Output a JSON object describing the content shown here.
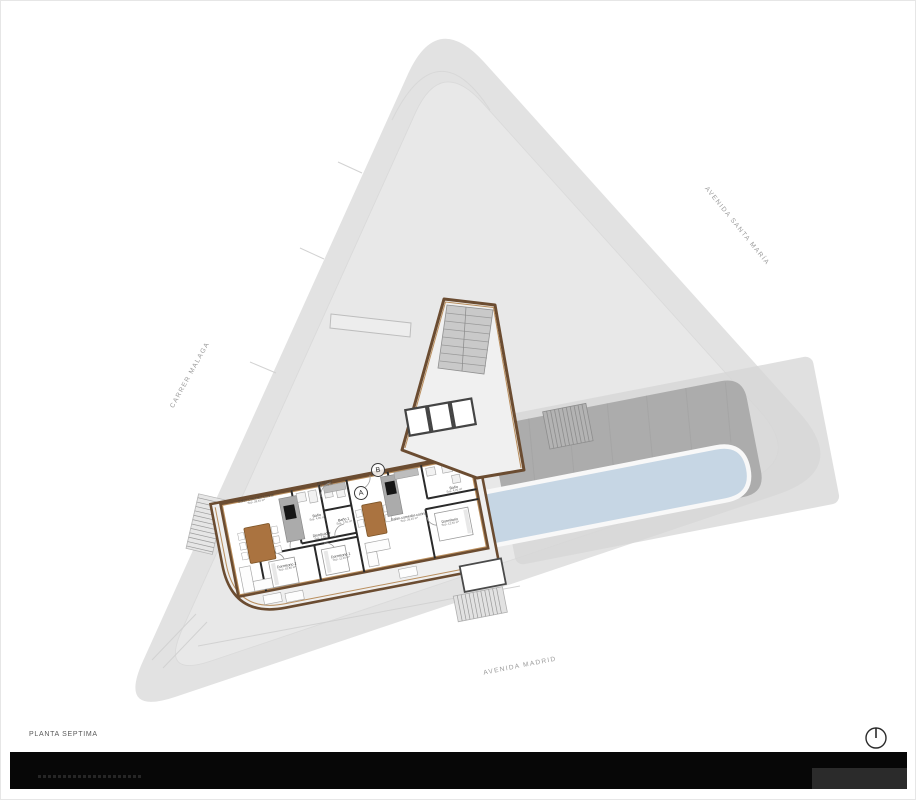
{
  "plan": {
    "title": "PLANTA SEPTIMA"
  },
  "streets": {
    "santa_maria": "AVENIDA SANTA MARÍA",
    "malaga": "CARRER MALAGA",
    "madrid": "AVENIDA MADRID"
  },
  "markers": {
    "a": "A",
    "b": "B"
  },
  "rooms": {
    "b_salon": {
      "name": "Salón-comedor-cocina",
      "area": "Sup. 28,45 m²"
    },
    "b_recibidor": {
      "name": "Recibidor",
      "area": "Sup. 3,90 m²"
    },
    "b_bano": {
      "name": "Baño",
      "area": "Sup. 4,05 m²"
    },
    "b_bano1": {
      "name": "Baño 1",
      "area": "Sup. 3,55 m²"
    },
    "b_distribuidor": {
      "name": "Distribuidor",
      "area": "Sup. 2,80 m²"
    },
    "b_dorm2": {
      "name": "Dormitorio 2",
      "area": "Sup. 10,80 m²"
    },
    "b_dorm1": {
      "name": "Dormitorio 1",
      "area": "Sup. 11,25 m²"
    },
    "a_salon": {
      "name": "Salón-comedor-cocina",
      "area": "Sup. 26,10 m²"
    },
    "a_bano": {
      "name": "Baño",
      "area": "Sup. 4,20 m²"
    },
    "a_dorm": {
      "name": "Dormitorio",
      "area": "Sup. 12,35 m²"
    }
  },
  "colors": {
    "site": "#e2e2e2",
    "deck": "#acacac",
    "pool": "#c6d6e4",
    "wall_brown": "#6b4c31",
    "wood": "#aa7340",
    "footer": "#070707"
  },
  "icons": {
    "compass": "north-indicator"
  }
}
